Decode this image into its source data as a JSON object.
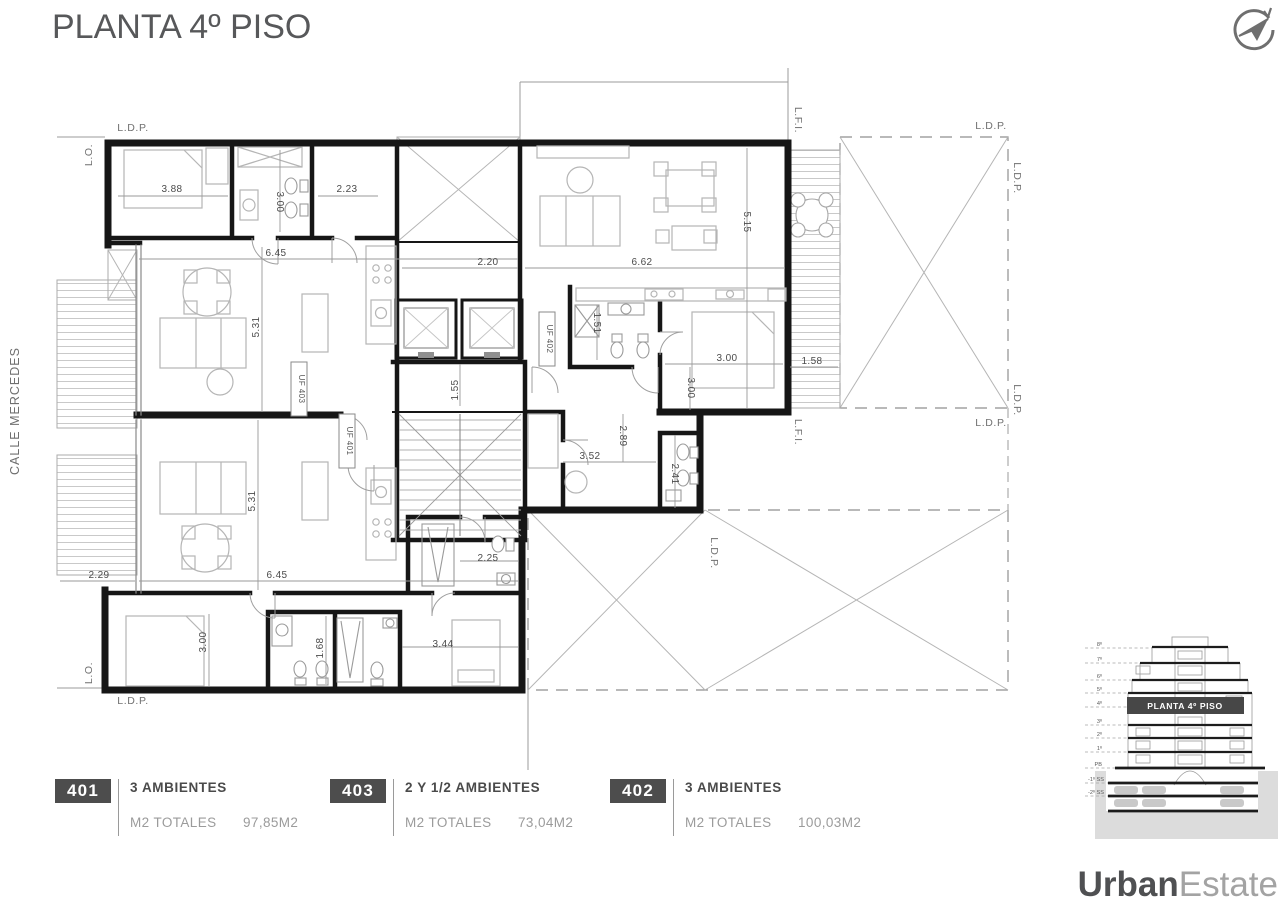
{
  "header": {
    "title": "PLANTA 4º PISO"
  },
  "street_label": "CALLE MERCEDES",
  "plan": {
    "unit_tags": [
      {
        "t": "UF 403"
      },
      {
        "t": "UF 401"
      },
      {
        "t": "UF 402"
      }
    ],
    "boundary_labels": [
      {
        "t": "L.D.P."
      },
      {
        "t": "L.O."
      },
      {
        "t": "L.F.I."
      },
      {
        "t": "L.D.P."
      },
      {
        "t": "L.D.P."
      },
      {
        "t": "L.D.P."
      },
      {
        "t": "L.D.P."
      },
      {
        "t": "L.F.I."
      },
      {
        "t": "L.D.P."
      },
      {
        "t": "L.O."
      },
      {
        "t": "L.D.P."
      }
    ],
    "dims": [
      {
        "t": "3.88"
      },
      {
        "t": "3.00"
      },
      {
        "t": "2.23"
      },
      {
        "t": "6.45"
      },
      {
        "t": "2.20"
      },
      {
        "t": "6.62"
      },
      {
        "t": "5.15"
      },
      {
        "t": "1.55"
      },
      {
        "t": "1.51"
      },
      {
        "t": "3.00"
      },
      {
        "t": "1.58"
      },
      {
        "t": "3.00"
      },
      {
        "t": "2.89"
      },
      {
        "t": "3.52"
      },
      {
        "t": "2.41"
      },
      {
        "t": "5.31"
      },
      {
        "t": "5.31"
      },
      {
        "t": "2.29"
      },
      {
        "t": "6.45"
      },
      {
        "t": "3.00"
      },
      {
        "t": "1.68"
      },
      {
        "t": "2.25"
      },
      {
        "t": "3.44"
      }
    ]
  },
  "legend": [
    {
      "code": "401",
      "type": "3 AMBIENTES",
      "area_label": "M2 TOTALES",
      "area_value": "97,85M2"
    },
    {
      "code": "403",
      "type": "2 Y 1/2  AMBIENTES",
      "area_label": "M2 TOTALES",
      "area_value": "73,04M2"
    },
    {
      "code": "402",
      "type": "3  AMBIENTES",
      "area_label": "M2 TOTALES",
      "area_value": "100,03M2"
    }
  ],
  "elevation": {
    "banner": "PLANTA 4º PISO",
    "floors": [
      "8º",
      "7º",
      "6º",
      "5º",
      "4º",
      "3º",
      "2º",
      "1º",
      "PB",
      "-1º SS",
      "-2º SS"
    ]
  },
  "brand": {
    "bold": "Urban",
    "light": "Estate"
  },
  "colors": {
    "badge": "#4d4d4d",
    "banner": "#474747",
    "wall": "#161616"
  }
}
